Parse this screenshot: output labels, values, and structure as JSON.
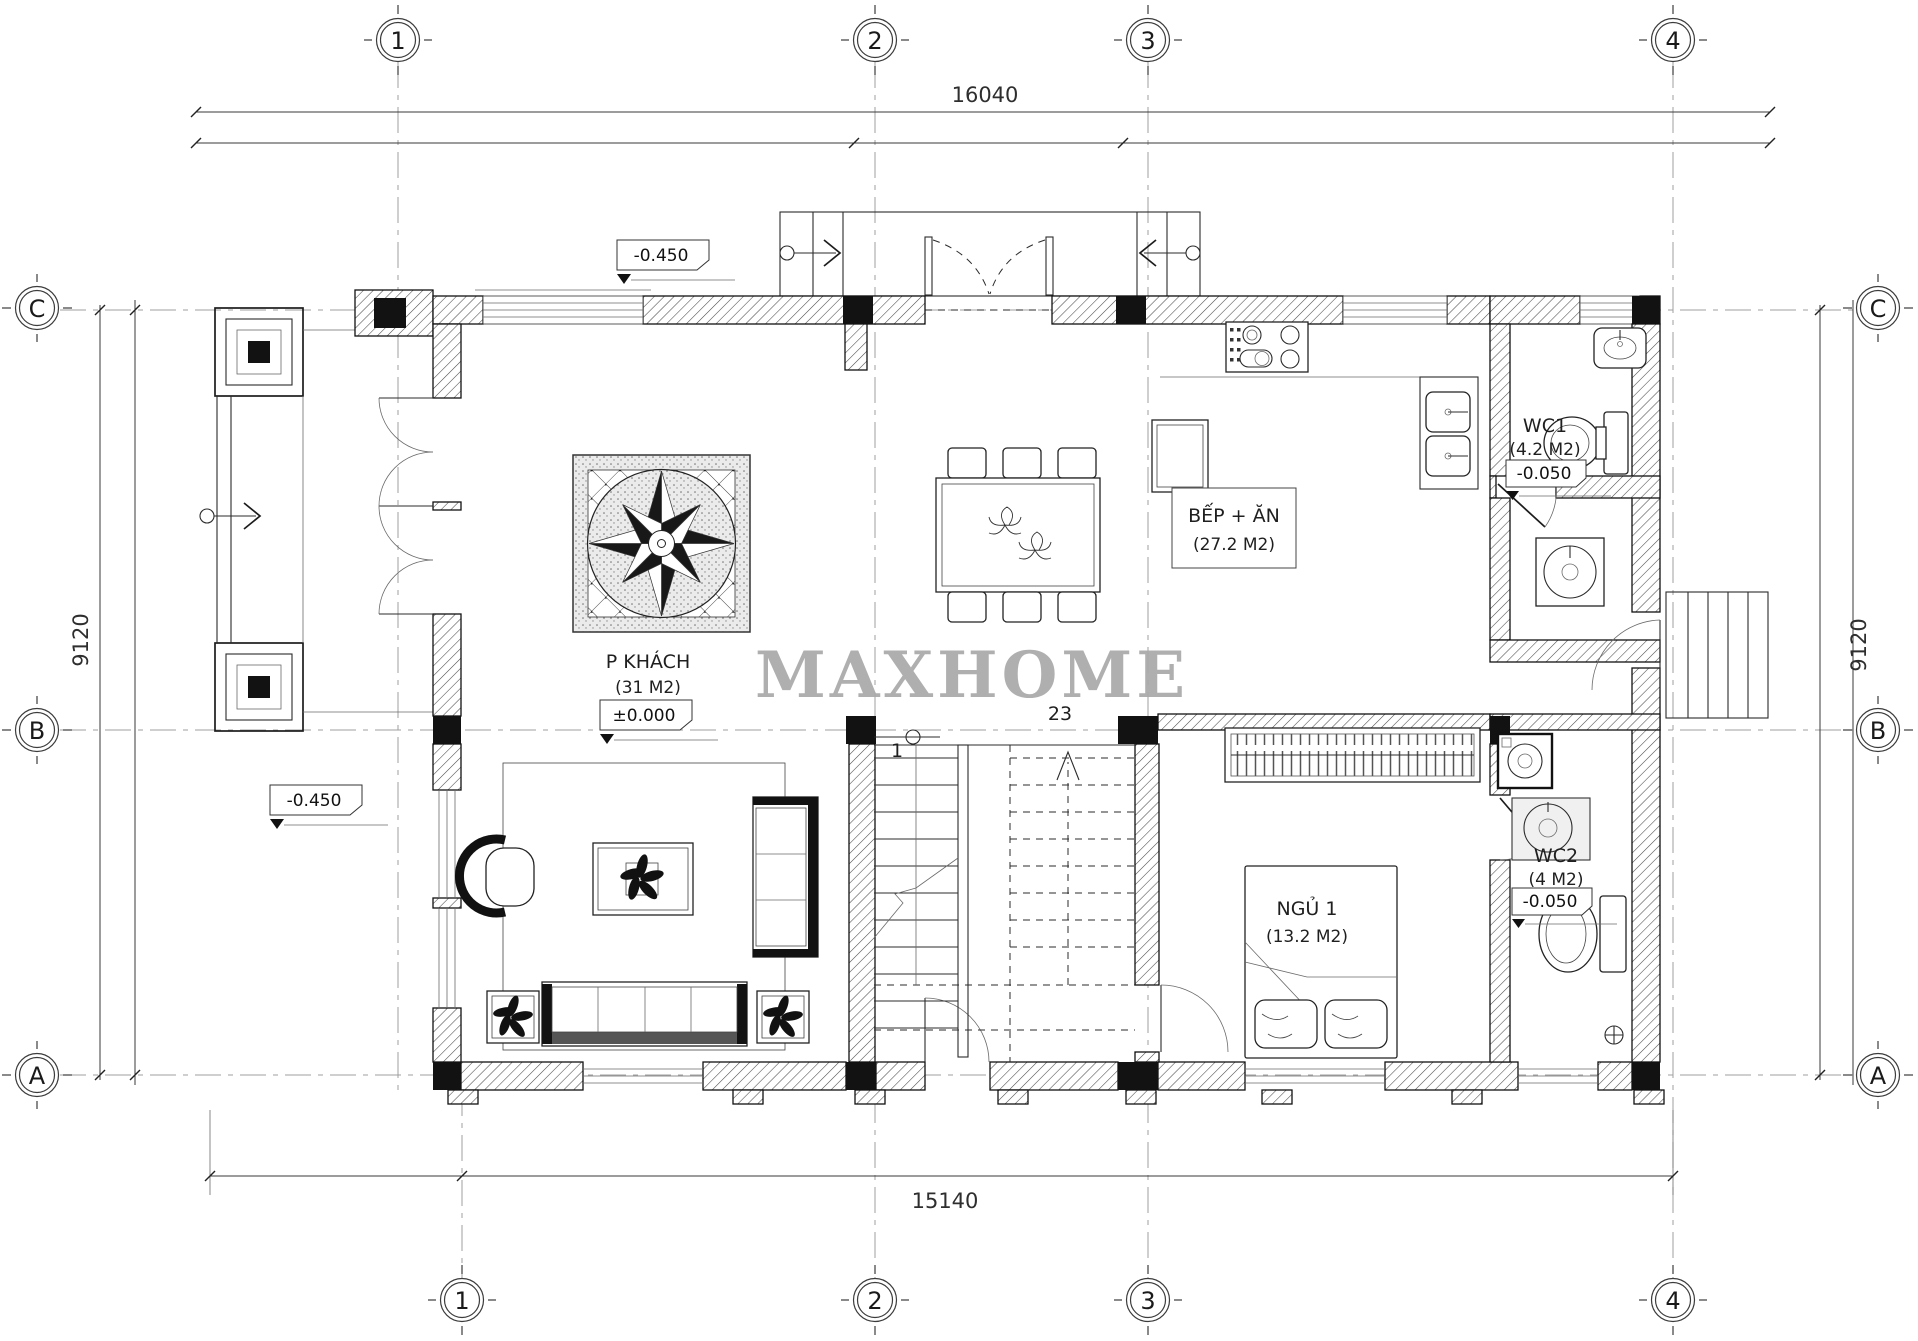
{
  "watermark": "MAXHOME",
  "colors": {
    "line": "#1f1f1f",
    "watermark": "#a9a9a9",
    "background": "#ffffff"
  },
  "axes": {
    "top": [
      "1",
      "2",
      "3",
      "4"
    ],
    "bottom": [
      "1",
      "2",
      "3",
      "4"
    ],
    "left": [
      "C",
      "B",
      "A"
    ],
    "right": [
      "C",
      "B",
      "A"
    ]
  },
  "dimensions": {
    "top": "16040",
    "bottom": "15140",
    "left": "9120",
    "right": "9120"
  },
  "levels": {
    "entry": "-0.450",
    "porch": "-0.450",
    "living": "±0.000",
    "wc1": "-0.050",
    "wc2": "-0.050"
  },
  "rooms": {
    "living": {
      "name": "P KHÁCH",
      "area": "(31 M2)"
    },
    "kitchen": {
      "name": "BẾP + ĂN",
      "area": "(27.2 M2)"
    },
    "wc1": {
      "name": "WC1",
      "area": "(4.2 M2)"
    },
    "wc2": {
      "name": "WC2",
      "area": "(4 M2)"
    },
    "bedroom": {
      "name": "NGỦ 1",
      "area": "(13.2 M2)"
    }
  },
  "stairs": {
    "start": "1",
    "end": "23"
  }
}
